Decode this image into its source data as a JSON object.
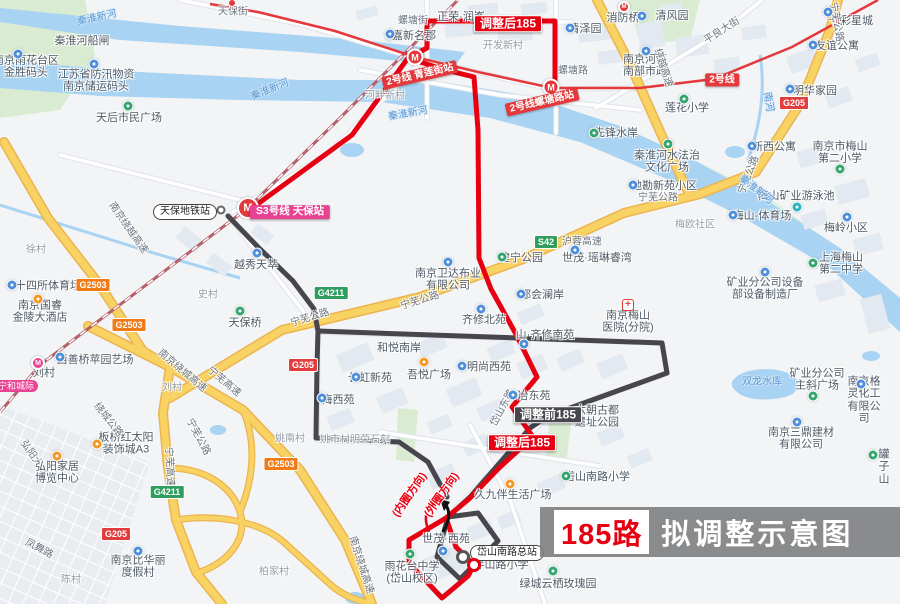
{
  "title": {
    "route_no": "185路",
    "text": "拟调整示意图"
  },
  "colors": {
    "route_after": "#e60012",
    "route_before": "#46464c",
    "metro_line2": "#e4393c",
    "metro_s3": "#e84393",
    "highway": "#f8d263",
    "water": "#a9d3f2",
    "land": "#f2f4f6",
    "building": "#e3e9f0",
    "park": "#d9ecd2",
    "badge_national_road": "#e23c3c",
    "badge_expressway": "#2f9e5f",
    "badge_ring_expressway": "#ef7b18"
  },
  "labels": [
    {
      "t": "秦淮新河",
      "x": 97,
      "y": 18,
      "k": "w",
      "r": -12
    },
    {
      "t": "秦淮河船闸",
      "x": 82,
      "y": 41,
      "k": "p"
    },
    {
      "t": "南京雨花台区\n金胜码头",
      "x": 26,
      "y": 67,
      "k": "p"
    },
    {
      "t": "江苏省防汛物资\n南京储运码头",
      "x": 96,
      "y": 81,
      "k": "p"
    },
    {
      "t": "秦淮新河",
      "x": 270,
      "y": 90,
      "k": "w",
      "r": -22
    },
    {
      "t": "天后市民广场",
      "x": 129,
      "y": 118,
      "k": "p"
    },
    {
      "t": "天保街",
      "x": 233,
      "y": 12,
      "k": "rd"
    },
    {
      "t": "螺塘街",
      "x": 413,
      "y": 21,
      "k": "rd"
    },
    {
      "t": "正荣·润峯",
      "x": 461,
      "y": 17,
      "k": "p"
    },
    {
      "t": "嘉新名郡",
      "x": 414,
      "y": 36,
      "k": "p"
    },
    {
      "t": "开发新村",
      "x": 503,
      "y": 46,
      "k": "a"
    },
    {
      "t": "清泽园",
      "x": 585,
      "y": 29,
      "k": "p"
    },
    {
      "t": "清风园",
      "x": 672,
      "y": 16,
      "k": "p"
    },
    {
      "t": "消防桥",
      "x": 623,
      "y": 18,
      "k": "p"
    },
    {
      "t": "七彩星城",
      "x": 851,
      "y": 21,
      "k": "p"
    },
    {
      "t": "友谊公寓",
      "x": 837,
      "y": 46,
      "k": "p"
    },
    {
      "t": "平良大街",
      "x": 722,
      "y": 31,
      "k": "rd",
      "r": -32
    },
    {
      "t": "南京河西\n南部市政",
      "x": 645,
      "y": 66,
      "k": "p"
    },
    {
      "t": "明华家园",
      "x": 815,
      "y": 91,
      "k": "p"
    },
    {
      "t": "莲花小学",
      "x": 687,
      "y": 108,
      "k": "p"
    },
    {
      "t": "南河",
      "x": 768,
      "y": 102,
      "k": "w",
      "r": 80
    },
    {
      "t": "螺塘路",
      "x": 573,
      "y": 71,
      "k": "rd"
    },
    {
      "t": "河畔新村",
      "x": 385,
      "y": 96,
      "k": "a"
    },
    {
      "t": "秦淮新河",
      "x": 408,
      "y": 114,
      "k": "w",
      "r": -10
    },
    {
      "t": "先锋水岸",
      "x": 616,
      "y": 133,
      "k": "p"
    },
    {
      "t": "秦淮河水法治\n文化广场",
      "x": 667,
      "y": 162,
      "k": "p"
    },
    {
      "t": "新西公寓",
      "x": 774,
      "y": 147,
      "k": "p"
    },
    {
      "t": "南京市梅山\n第二小学",
      "x": 840,
      "y": 153,
      "k": "p"
    },
    {
      "t": "地勘新苑小区",
      "x": 664,
      "y": 186,
      "k": "p"
    },
    {
      "t": "宁芜公路",
      "x": 658,
      "y": 198,
      "k": "rd"
    },
    {
      "t": "宁芜公路",
      "x": 749,
      "y": 175,
      "k": "rd",
      "r": -68
    },
    {
      "t": "梅山矿业游泳池",
      "x": 796,
      "y": 196,
      "k": "p"
    },
    {
      "t": "秦淮新河",
      "x": 756,
      "y": 190,
      "k": "w",
      "r": 38
    },
    {
      "t": "梅岭小区",
      "x": 846,
      "y": 228,
      "k": "p"
    },
    {
      "t": "梅山-体育场",
      "x": 762,
      "y": 216,
      "k": "p"
    },
    {
      "t": "梅欧社区",
      "x": 695,
      "y": 225,
      "k": "a"
    },
    {
      "t": "世茂·瑶琳睿湾",
      "x": 597,
      "y": 258,
      "k": "p"
    },
    {
      "t": "上海梅山\n第二中学",
      "x": 841,
      "y": 264,
      "k": "p"
    },
    {
      "t": "矿业分公司设备\n部设备制造厂",
      "x": 765,
      "y": 289,
      "k": "p"
    },
    {
      "t": "南京梅山\n医院(分院)",
      "x": 628,
      "y": 322,
      "k": "p"
    },
    {
      "t": "双龙水库",
      "x": 762,
      "y": 382,
      "k": "w"
    },
    {
      "t": "矿业分公司\n主斜广场",
      "x": 817,
      "y": 380,
      "k": "p"
    },
    {
      "t": "南京格灵化工\n有限公司",
      "x": 864,
      "y": 400,
      "k": "p"
    },
    {
      "t": "南京三鼎建材\n有限公司",
      "x": 801,
      "y": 439,
      "k": "p"
    },
    {
      "t": "罐子山",
      "x": 884,
      "y": 467,
      "k": "p"
    },
    {
      "t": "绕越高速",
      "x": 663,
      "y": 68,
      "k": "rd",
      "r": 72
    },
    {
      "t": "宁芜公路",
      "x": 836,
      "y": 22,
      "k": "rd",
      "r": 80
    },
    {
      "t": "2号线",
      "x": 722,
      "y": 80,
      "k": "m2"
    },
    {
      "t": "S42",
      "x": 546,
      "y": 242,
      "k": "gG"
    },
    {
      "t": "沪蓉高速",
      "x": 582,
      "y": 242,
      "k": "rd"
    },
    {
      "t": "G205",
      "x": 794,
      "y": 103,
      "k": "gR"
    },
    {
      "t": "G205",
      "x": 303,
      "y": 365,
      "k": "gR"
    },
    {
      "t": "G205",
      "x": 116,
      "y": 534,
      "k": "gR"
    },
    {
      "t": "G4211",
      "x": 331,
      "y": 293,
      "k": "gG"
    },
    {
      "t": "G4211",
      "x": 167,
      "y": 492,
      "k": "gG"
    },
    {
      "t": "G2503",
      "x": 93,
      "y": 285,
      "k": "gO"
    },
    {
      "t": "G2503",
      "x": 129,
      "y": 325,
      "k": "gO"
    },
    {
      "t": "G2503",
      "x": 281,
      "y": 464,
      "k": "gO"
    },
    {
      "t": "南京绕越高速",
      "x": 128,
      "y": 228,
      "k": "rd",
      "r": 55
    },
    {
      "t": "徐村",
      "x": 36,
      "y": 250,
      "k": "a"
    },
    {
      "t": "十四所体育场",
      "x": 48,
      "y": 286,
      "k": "p"
    },
    {
      "t": "南京国睿\n金陵大酒店",
      "x": 40,
      "y": 312,
      "k": "p"
    },
    {
      "t": "西善桥苹园艺场",
      "x": 95,
      "y": 360,
      "k": "p"
    },
    {
      "t": "刘村",
      "x": 44,
      "y": 373,
      "k": "p"
    },
    {
      "t": "天保地铁站",
      "x": 185,
      "y": 212,
      "k": "bub"
    },
    {
      "t": "S3号线 天保站",
      "x": 290,
      "y": 212,
      "k": "s3"
    },
    {
      "t": "越秀天萃",
      "x": 256,
      "y": 265,
      "k": "p"
    },
    {
      "t": "史村",
      "x": 208,
      "y": 295,
      "k": "a"
    },
    {
      "t": "天保桥",
      "x": 245,
      "y": 323,
      "k": "p"
    },
    {
      "t": "刘村",
      "x": 172,
      "y": 388,
      "k": "a"
    },
    {
      "t": "南京绕城高速",
      "x": 182,
      "y": 371,
      "k": "rd",
      "r": 40
    },
    {
      "t": "宁芜高速",
      "x": 224,
      "y": 382,
      "k": "rd",
      "r": 40
    },
    {
      "t": "姚南村",
      "x": 290,
      "y": 439,
      "k": "a"
    },
    {
      "t": "宁和城际",
      "x": 16,
      "y": 386,
      "k": "ln"
    },
    {
      "t": "梅西苑",
      "x": 338,
      "y": 400,
      "k": "p"
    },
    {
      "t": "长虹新苑",
      "x": 370,
      "y": 378,
      "k": "p"
    },
    {
      "t": "和悦南岸",
      "x": 399,
      "y": 348,
      "k": "p"
    },
    {
      "t": "吾悦广场",
      "x": 429,
      "y": 375,
      "k": "p"
    },
    {
      "t": "齐修北苑",
      "x": 484,
      "y": 320,
      "k": "p"
    },
    {
      "t": "都会澜岸",
      "x": 542,
      "y": 295,
      "k": "p"
    },
    {
      "t": "山·齐修南苑",
      "x": 545,
      "y": 335,
      "k": "p"
    },
    {
      "t": "明尚西苑",
      "x": 489,
      "y": 367,
      "k": "p"
    },
    {
      "t": "建宁公园",
      "x": 521,
      "y": 258,
      "k": "p"
    },
    {
      "t": "南京卫达布业\n有限公司",
      "x": 448,
      "y": 280,
      "k": "p"
    },
    {
      "t": "宁芜公路",
      "x": 310,
      "y": 318,
      "k": "rd",
      "r": -17
    },
    {
      "t": "宁芜公路",
      "x": 420,
      "y": 301,
      "k": "rd",
      "r": -17
    },
    {
      "t": "姚市村明荣石刻",
      "x": 355,
      "y": 440,
      "k": "a"
    },
    {
      "t": "岱山东路",
      "x": 503,
      "y": 408,
      "k": "rd",
      "r": -62
    },
    {
      "t": "冶东苑",
      "x": 534,
      "y": 396,
      "k": "p"
    },
    {
      "t": "六朝古都\n遗址公园",
      "x": 597,
      "y": 417,
      "k": "p"
    },
    {
      "t": "调整前185",
      "x": 548,
      "y": 415,
      "k": "bb"
    },
    {
      "t": "调整后185",
      "x": 522,
      "y": 443,
      "k": "ba"
    },
    {
      "t": "调整后185",
      "x": 508,
      "y": 24,
      "k": "ba"
    },
    {
      "t": "2号线 青莲街站",
      "x": 420,
      "y": 75,
      "k": "m2",
      "r": -13
    },
    {
      "t": "2号线螺塘路站",
      "x": 542,
      "y": 102,
      "k": "m2",
      "r": -13
    },
    {
      "t": "(内圈方向)",
      "x": 410,
      "y": 495,
      "k": "dir",
      "r": -55
    },
    {
      "t": "(外圈方向)",
      "x": 442,
      "y": 495,
      "k": "dir",
      "r": -55
    },
    {
      "t": "岱山南路小学",
      "x": 597,
      "y": 477,
      "k": "p"
    },
    {
      "t": "久九伴生活广场",
      "x": 513,
      "y": 495,
      "k": "p"
    },
    {
      "t": "岱山南路总站",
      "x": 507,
      "y": 553,
      "k": "bub"
    },
    {
      "t": "伴山路小学",
      "x": 501,
      "y": 565,
      "k": "p"
    },
    {
      "t": "世茂·西苑",
      "x": 446,
      "y": 539,
      "k": "p"
    },
    {
      "t": "雨花台中学\n(岱山校区)",
      "x": 412,
      "y": 573,
      "k": "p"
    },
    {
      "t": "绿城云栖玫瑰园",
      "x": 558,
      "y": 584,
      "k": "p"
    },
    {
      "t": "弘阳大道",
      "x": 34,
      "y": 458,
      "k": "rd",
      "r": 55
    },
    {
      "t": "弘阳家居\n博览中心",
      "x": 57,
      "y": 473,
      "k": "p"
    },
    {
      "t": "板桥红太阳\n装饰城A3",
      "x": 126,
      "y": 444,
      "k": "p"
    },
    {
      "t": "绕城公路",
      "x": 108,
      "y": 420,
      "k": "rd",
      "r": 52
    },
    {
      "t": "宁芜高速",
      "x": 169,
      "y": 467,
      "k": "rd",
      "r": 87
    },
    {
      "t": "宁芜公路",
      "x": 198,
      "y": 437,
      "k": "rd",
      "r": 62
    },
    {
      "t": "凤舞路",
      "x": 39,
      "y": 549,
      "k": "rd",
      "r": 28
    },
    {
      "t": "南京比华丽\n度假村",
      "x": 138,
      "y": 567,
      "k": "p"
    },
    {
      "t": "陈村",
      "x": 71,
      "y": 580,
      "k": "a"
    },
    {
      "t": "柏家村",
      "x": 274,
      "y": 572,
      "k": "a"
    },
    {
      "t": "南京绕城高速",
      "x": 361,
      "y": 565,
      "k": "rd",
      "r": 72
    }
  ],
  "icons": [
    {
      "k": "poi",
      "c": "blue",
      "x": 18,
      "y": 54
    },
    {
      "k": "poi",
      "c": "blue",
      "x": 94,
      "y": 64
    },
    {
      "k": "poi",
      "c": "green",
      "x": 128,
      "y": 106
    },
    {
      "k": "dotred",
      "x": 232,
      "y": 3
    },
    {
      "k": "poi",
      "c": "blue",
      "x": 390,
      "y": 34
    },
    {
      "k": "poi",
      "c": "blue",
      "x": 570,
      "y": 28
    },
    {
      "k": "poi",
      "c": "blue",
      "x": 642,
      "y": 16
    },
    {
      "k": "msm",
      "x": 624,
      "y": 7
    },
    {
      "k": "poi",
      "c": "blue",
      "x": 828,
      "y": 12
    },
    {
      "k": "poi",
      "c": "blue",
      "x": 813,
      "y": 45
    },
    {
      "k": "poi",
      "c": "blue",
      "x": 646,
      "y": 51
    },
    {
      "k": "poi",
      "c": "blue",
      "x": 790,
      "y": 89
    },
    {
      "k": "poi",
      "c": "green",
      "x": 684,
      "y": 99
    },
    {
      "k": "m",
      "x": 415,
      "y": 57
    },
    {
      "k": "m",
      "x": 551,
      "y": 87
    },
    {
      "k": "poi",
      "c": "green",
      "x": 594,
      "y": 133
    },
    {
      "k": "poi",
      "c": "green",
      "x": 668,
      "y": 144
    },
    {
      "k": "poi",
      "c": "blue",
      "x": 752,
      "y": 146
    },
    {
      "k": "poi",
      "c": "green",
      "x": 840,
      "y": 169
    },
    {
      "k": "poi",
      "c": "blue",
      "x": 633,
      "y": 185
    },
    {
      "k": "poi",
      "c": "teal",
      "x": 797,
      "y": 207
    },
    {
      "k": "poi",
      "c": "blue",
      "x": 847,
      "y": 217
    },
    {
      "k": "poi",
      "c": "blue",
      "x": 733,
      "y": 215
    },
    {
      "k": "poi",
      "c": "blue",
      "x": 575,
      "y": 250
    },
    {
      "k": "poi",
      "c": "green",
      "x": 813,
      "y": 263
    },
    {
      "k": "poi",
      "c": "blue",
      "x": 765,
      "y": 272
    },
    {
      "k": "hosp",
      "x": 628,
      "y": 305
    },
    {
      "k": "poi",
      "c": "green",
      "x": 813,
      "y": 396
    },
    {
      "k": "poi",
      "c": "blue",
      "x": 861,
      "y": 384
    },
    {
      "k": "poi",
      "c": "blue",
      "x": 797,
      "y": 422
    },
    {
      "k": "poi",
      "c": "green",
      "x": 873,
      "y": 455
    },
    {
      "k": "mbig",
      "x": 248,
      "y": 208
    },
    {
      "k": "stop",
      "x": 221,
      "y": 210
    },
    {
      "k": "poi",
      "c": "blue",
      "x": 257,
      "y": 253
    },
    {
      "k": "poi",
      "c": "green",
      "x": 240,
      "y": 311
    },
    {
      "k": "poi",
      "c": "blue",
      "x": 12,
      "y": 285
    },
    {
      "k": "poi",
      "c": "orange",
      "x": 38,
      "y": 299
    },
    {
      "k": "poi",
      "c": "blue",
      "x": 60,
      "y": 357
    },
    {
      "k": "mpink",
      "x": 38,
      "y": 363
    },
    {
      "k": "poi",
      "c": "blue",
      "x": 322,
      "y": 398
    },
    {
      "k": "poi",
      "c": "blue",
      "x": 356,
      "y": 377
    },
    {
      "k": "poi",
      "c": "orange",
      "x": 424,
      "y": 362
    },
    {
      "k": "poi",
      "c": "blue",
      "x": 481,
      "y": 309
    },
    {
      "k": "poi",
      "c": "blue",
      "x": 521,
      "y": 294
    },
    {
      "k": "poi",
      "c": "blue",
      "x": 524,
      "y": 344
    },
    {
      "k": "poi",
      "c": "blue",
      "x": 462,
      "y": 366
    },
    {
      "k": "poi",
      "c": "green",
      "x": 502,
      "y": 257
    },
    {
      "k": "poi",
      "c": "blue",
      "x": 448,
      "y": 262
    },
    {
      "k": "poi",
      "c": "blue",
      "x": 513,
      "y": 395
    },
    {
      "k": "poi",
      "c": "green",
      "x": 566,
      "y": 476
    },
    {
      "k": "poi",
      "c": "orange",
      "x": 510,
      "y": 484
    },
    {
      "k": "poi",
      "c": "green",
      "x": 553,
      "y": 571
    },
    {
      "k": "poi",
      "c": "green",
      "x": 410,
      "y": 554
    },
    {
      "k": "poi",
      "c": "blue",
      "x": 443,
      "y": 551
    },
    {
      "k": "poi",
      "c": "orange",
      "x": 57,
      "y": 456
    },
    {
      "k": "poi",
      "c": "orange",
      "x": 97,
      "y": 444
    },
    {
      "k": "poi",
      "c": "blue",
      "x": 138,
      "y": 551
    },
    {
      "k": "termgray",
      "x": 463,
      "y": 557
    },
    {
      "k": "termred",
      "x": 474,
      "y": 565
    }
  ]
}
